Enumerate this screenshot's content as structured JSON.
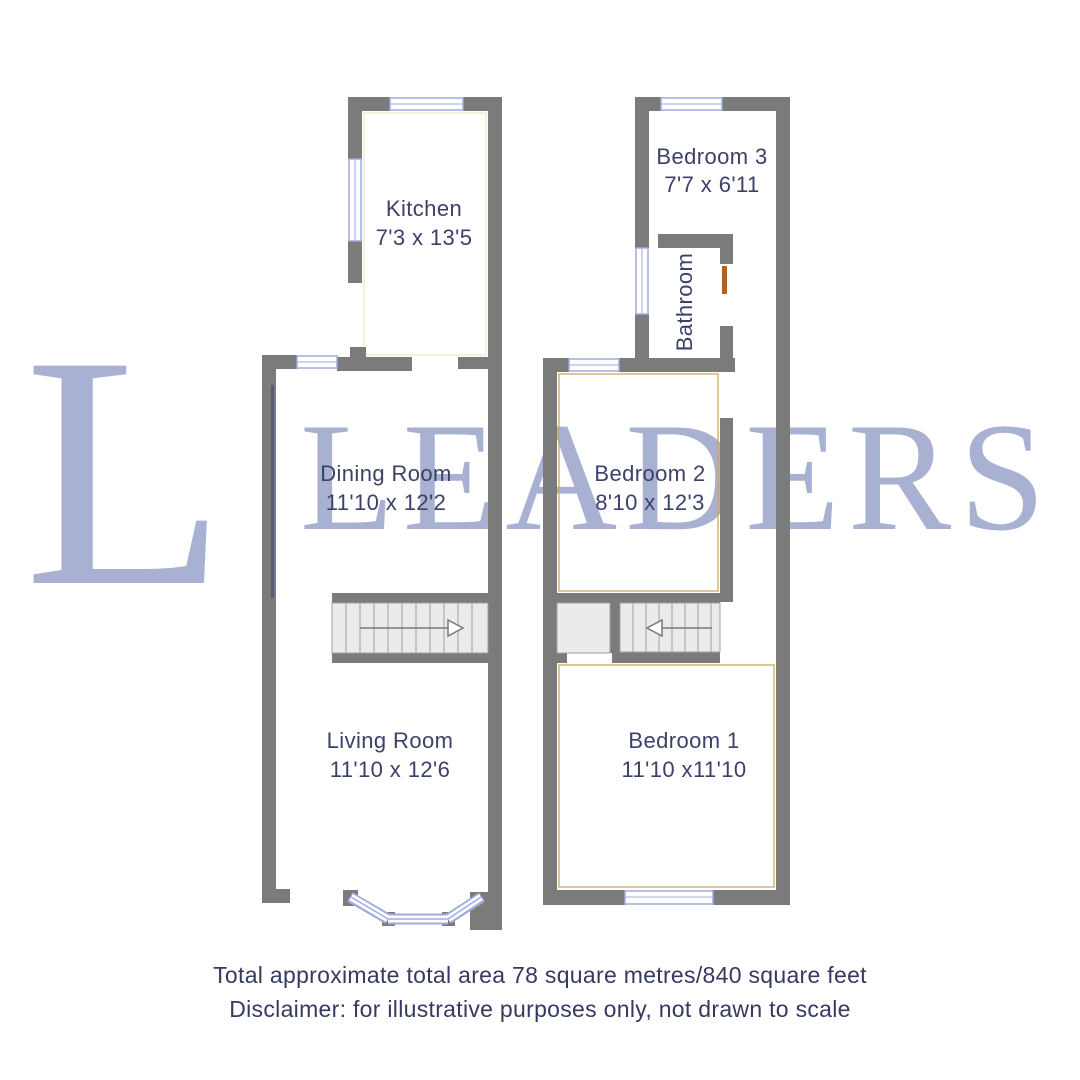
{
  "watermark": {
    "letter": "L",
    "word": "LEADERS",
    "color": "#a9b1d2"
  },
  "floorplan": {
    "ground_floor": {
      "kitchen": {
        "name": "Kitchen",
        "dims": "7'3 x 13'5"
      },
      "dining_room": {
        "name": "Dining Room",
        "dims": "11'10 x 12'2"
      },
      "living_room": {
        "name": "Living Room",
        "dims": "11'10 x 12'6"
      }
    },
    "first_floor": {
      "bedroom3": {
        "name": "Bedroom 3",
        "dims": "7'7 x 6'11"
      },
      "bathroom": {
        "name": "Bathroom"
      },
      "bedroom2": {
        "name": "Bedroom 2",
        "dims": "8'10 x 12'3"
      },
      "bedroom1": {
        "name": "Bedroom 1",
        "dims": "11'10 x11'10"
      }
    }
  },
  "footer": {
    "area_line": "Total approximate total area 78 square metres/840 square feet",
    "disclaimer_line": "Disclaimer: for illustrative purposes only, not drawn to scale"
  },
  "colors": {
    "wall": "#7b7b7b",
    "window": "#9fabdd",
    "label_text": "#3c4168",
    "stairs_fill": "#ebebeb",
    "door": "#a9642c",
    "inner_edge": "#cfa45f",
    "watermark": "#a9b1d2"
  }
}
